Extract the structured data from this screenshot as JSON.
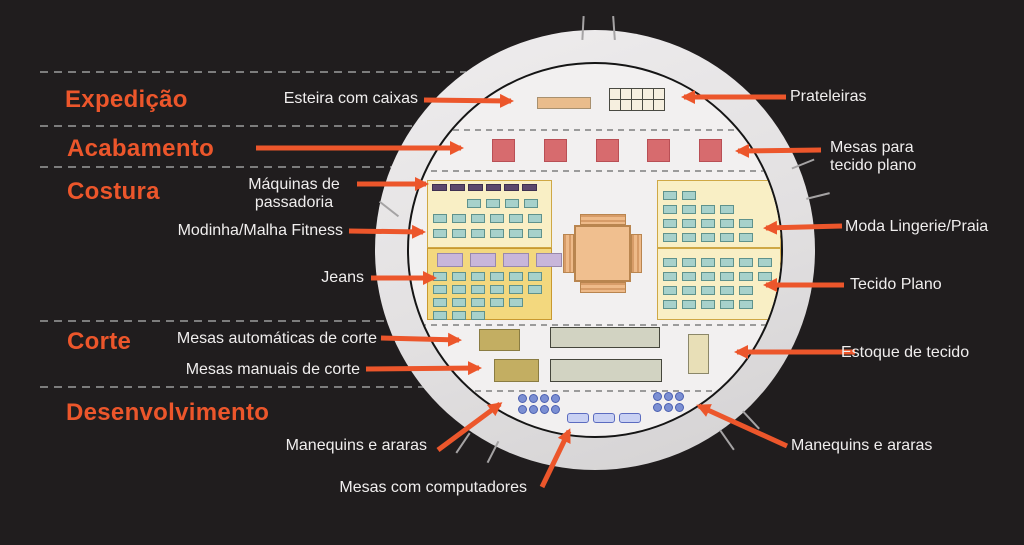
{
  "zones": [
    {
      "label": "Expedição"
    },
    {
      "label": "Acabamento"
    },
    {
      "label": "Costura"
    },
    {
      "label": "Corte"
    },
    {
      "label": "Desenvolvimento"
    }
  ],
  "callouts": {
    "esteira": "Esteira com caixas",
    "prateleiras": "Prateleiras",
    "mesas_tecido_line1": "Mesas para",
    "mesas_tecido_line2": "tecido plano",
    "maquinas_line1": "Máquinas de",
    "maquinas_line2": "passadoria",
    "modinha": "Modinha/Malha Fitness",
    "moda_lingerie": "Moda Lingerie/Praia",
    "jeans": "Jeans",
    "tecido_plano": "Tecido Plano",
    "mesas_automaticas": "Mesas automáticas de corte",
    "estoque": "Estoque de tecido",
    "mesas_manuais": "Mesas manuais de corte",
    "manequins_left": "Manequins e araras",
    "manequins_right": "Manequins e araras",
    "computadores": "Mesas com computadores"
  },
  "colors": {
    "bg": "#201d1e",
    "accent": "#ec562b",
    "text": "#f0eeee",
    "dash-outer": "#7d7d7d",
    "dash-inner": "#9b9b9b",
    "floor": "#f2f0f0",
    "panel-light": "#f9efc5",
    "panel-dark": "#f3d87e",
    "panel-border": "#cfa845",
    "teal": "#a7d1cb",
    "teal-border": "#5f928c",
    "purple": "#5c486c",
    "lavender": "#c8b6da",
    "red": "#d76b6e",
    "red-border": "#b94f55",
    "tan": "#e9bc8c",
    "table-center": "#f0bf8f",
    "olive": "#c3ae62",
    "graytable": "#d2d3c2",
    "estoque": "#e8dfb7",
    "dot": "#7b8fd3",
    "dot-border": "#4b5fb0",
    "computer": "#c9d1f3",
    "computer-border": "#5c6cc0"
  },
  "floorplan": {
    "shelves": {
      "cols": 5,
      "rows": 2
    },
    "red_tables": 5,
    "pressing_machines": 6,
    "lavender_tables": 4,
    "left_top_teal": [
      4,
      6,
      6
    ],
    "left_bottom_teal": [
      6,
      6,
      5,
      3
    ],
    "right_top_teal": [
      2,
      4,
      5,
      5
    ],
    "right_bottom_teal": [
      6,
      6,
      5,
      5
    ],
    "manequins_left": {
      "rows": 2,
      "cols": 4
    },
    "manequins_right": {
      "rows": 2,
      "cols": 3
    },
    "computers": 3
  }
}
